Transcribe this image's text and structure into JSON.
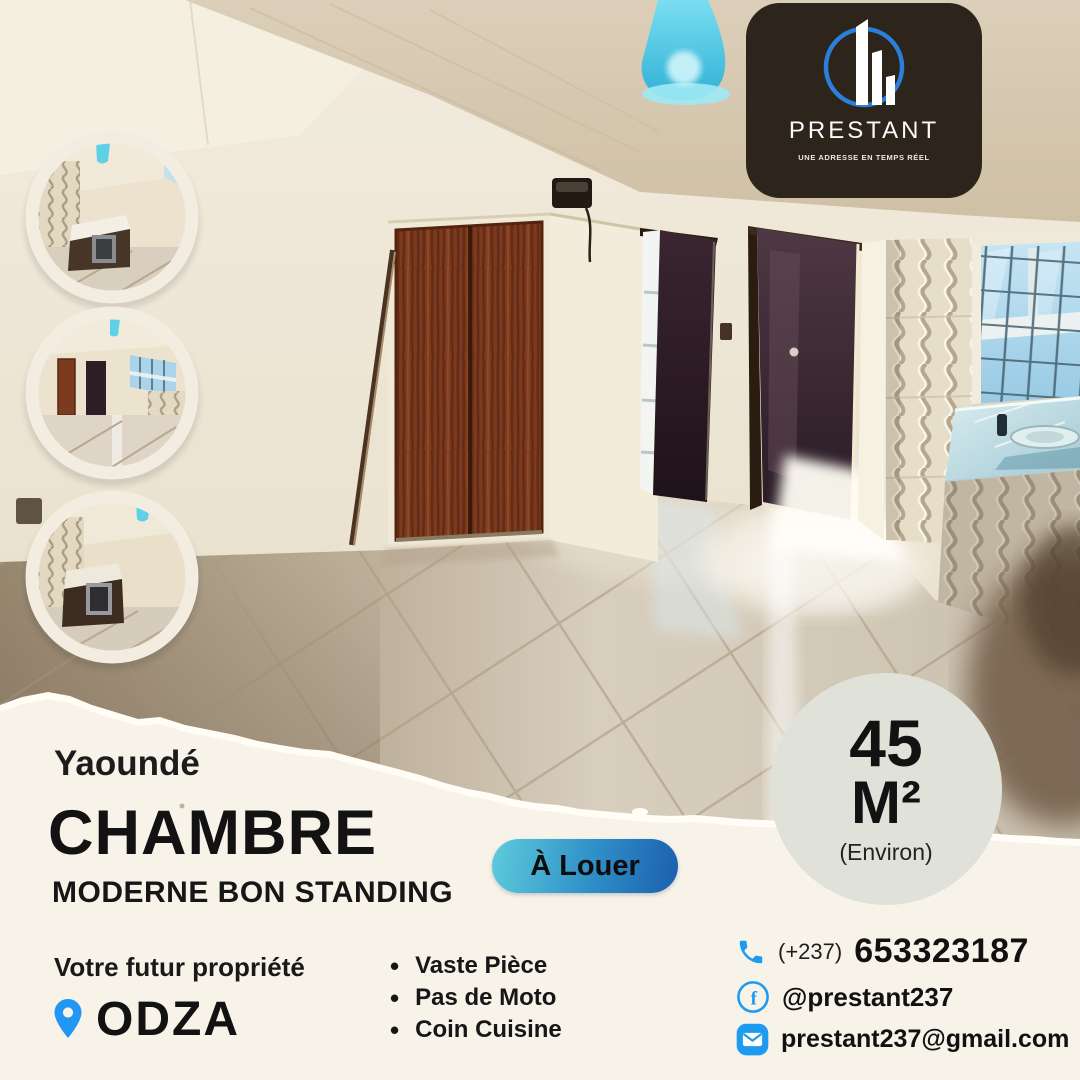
{
  "brand": {
    "name": "PRESTANT",
    "tagline": "UNE ADRESSE EN TEMPS RÉEL"
  },
  "listing": {
    "city": "Yaoundé",
    "title": "CHAMBRE",
    "subtitle": "MODERNE BON STANDING",
    "status_badge": "À Louer",
    "area_value": "45",
    "area_unit": "M²",
    "area_note": "(Environ)"
  },
  "location": {
    "label": "Votre futur propriété",
    "name": "ODZA"
  },
  "features": [
    "Vaste Pièce",
    "Pas de Moto",
    "Coin Cuisine"
  ],
  "contact": {
    "phone_prefix": "(+237)",
    "phone_number": "653323187",
    "facebook": "@prestant237",
    "email": "prestant237@gmail.com"
  },
  "icons": {
    "facebook_glyph": "f",
    "bullet_glyph": "•"
  },
  "colors": {
    "accent_blue": "#1d9bf0",
    "pin_blue": "#2196f3",
    "pill_gradient_start": "#5ecbdc",
    "pill_gradient_end": "#1c5fae",
    "paper_cream": "#f8f3e8",
    "area_circle_gray": "#e0e2da",
    "logo_panel_brown": "#2d241c",
    "logo_blue": "#2b7fdb"
  }
}
